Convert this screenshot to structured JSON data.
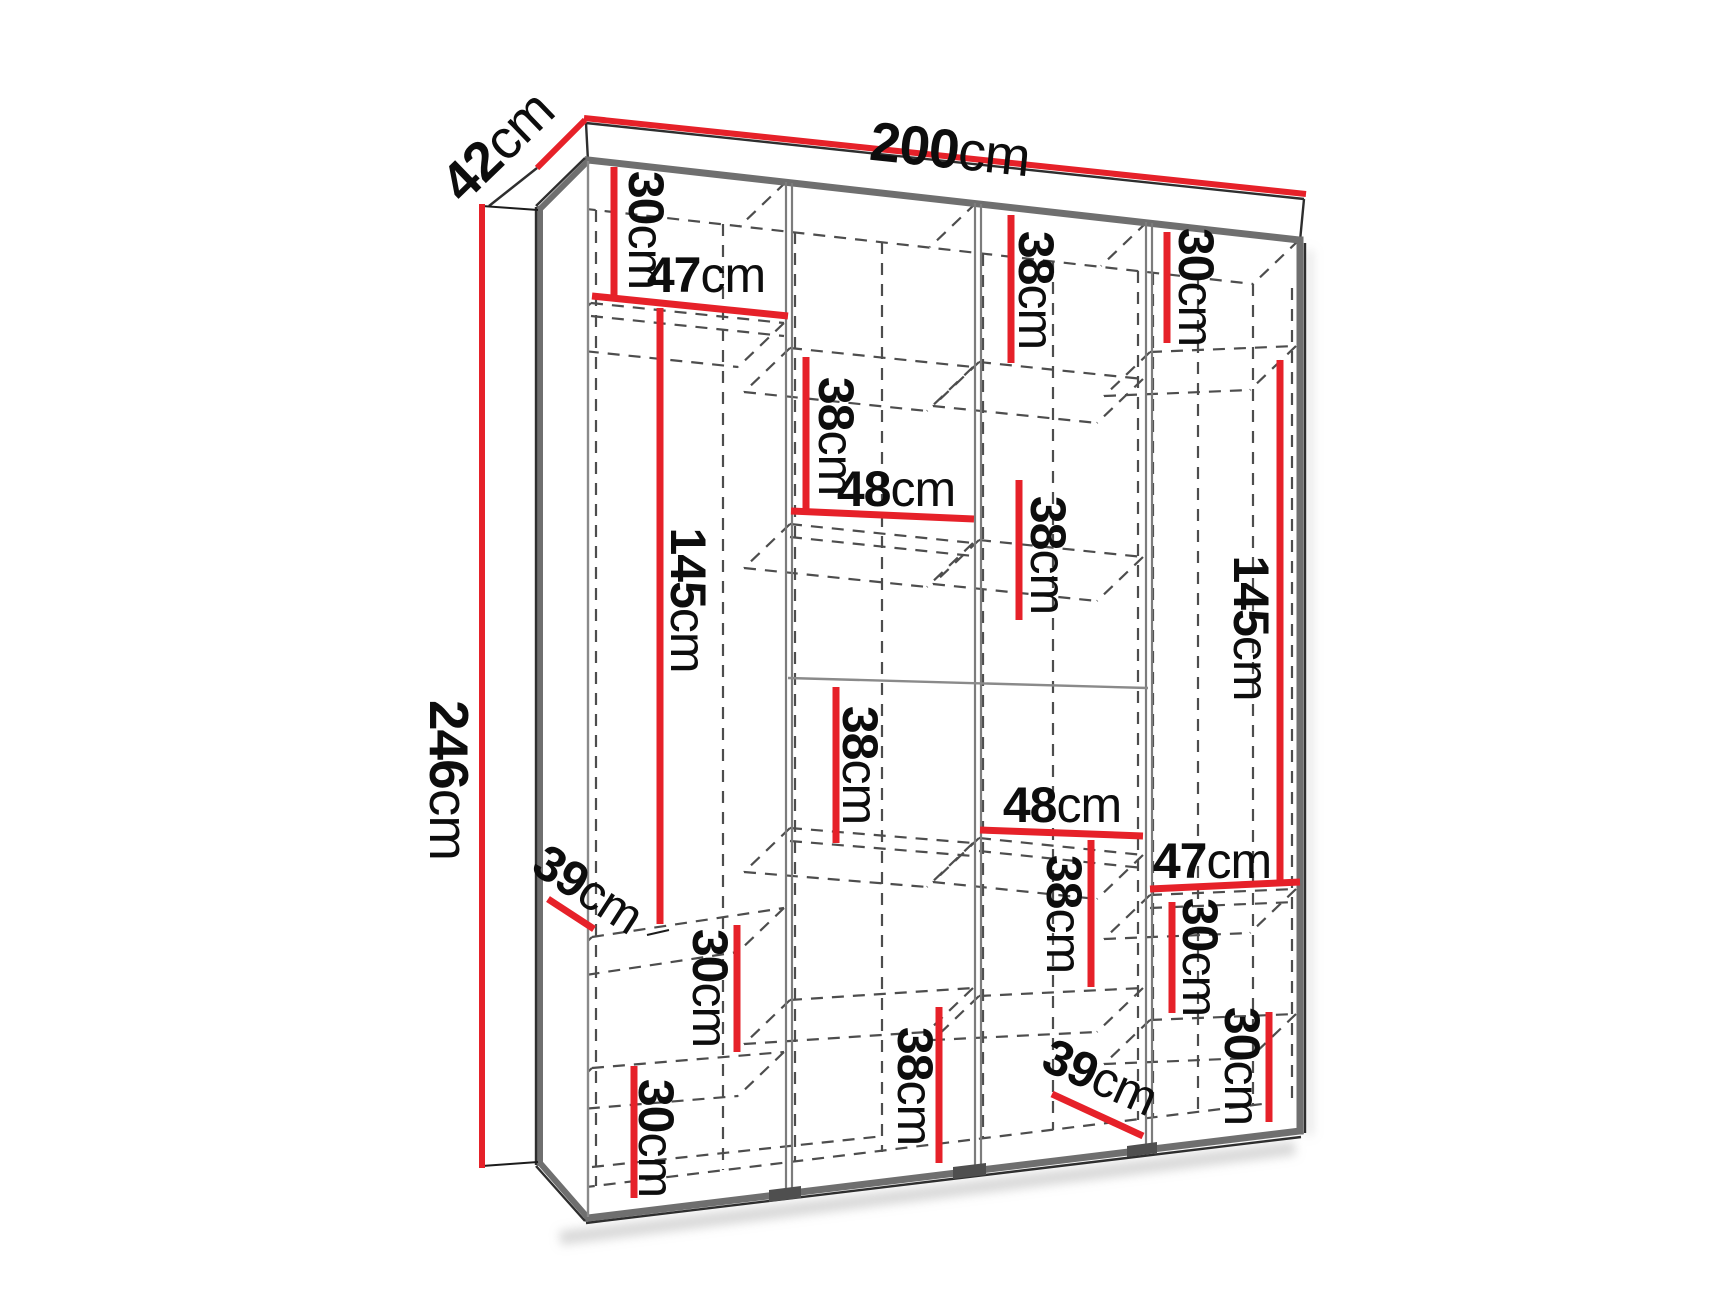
{
  "diagram": {
    "kind": "furniture dimension drawing",
    "subject": "wardrobe interior with 4 sections, shelves shown dashed",
    "unit": "cm"
  },
  "colors": {
    "dimension_line": "#e62129",
    "frame_gray": "#6f6f6f",
    "hidden_edge_gray": "#4d4d4d",
    "label_text": "#0d0d0d",
    "background": "#ffffff"
  },
  "overall": {
    "width": {
      "num": "200",
      "unit": "cm",
      "text": "200cm"
    },
    "depth": {
      "num": "42",
      "unit": "cm",
      "text": "42cm"
    },
    "height": {
      "num": "246",
      "unit": "cm",
      "text": "246cm"
    }
  },
  "labels": {
    "s1_top_30": {
      "num": "30",
      "unit": "cm",
      "text": "30cm"
    },
    "s1_shelf_47": {
      "num": "47",
      "unit": "cm",
      "text": "47cm"
    },
    "s1_hang_145": {
      "num": "145",
      "unit": "cm",
      "text": "145cm"
    },
    "left_depth_39response": {
      "num": "39",
      "unit": "cm",
      "text": "39cm"
    },
    "s1_low_30a": {
      "num": "30",
      "unit": "cm",
      "text": "30cm"
    },
    "s1_low_30b": {
      "num": "30",
      "unit": "cm",
      "text": "30cm"
    },
    "s2_top_38": {
      "num": "38",
      "unit": "cm",
      "text": "38cm"
    },
    "s2_shelf_48": {
      "num": "48",
      "unit": "cm",
      "text": "48cm"
    },
    "s2_mid_38": {
      "num": "38",
      "unit": "cm",
      "text": "38cm"
    },
    "s2_low_38": {
      "num": "38",
      "unit": "cm",
      "text": "38cm"
    },
    "s3_top_38": {
      "num": "38",
      "unit": "cm",
      "text": "38cm"
    },
    "s3_mid_38": {
      "num": "38",
      "unit": "cm",
      "text": "38cm"
    },
    "s3_shelf_48": {
      "num": "48",
      "unit": "cm",
      "text": "48cm"
    },
    "s3_low_38": {
      "num": "38",
      "unit": "cm",
      "text": "38cm"
    },
    "s3_depth_39": {
      "num": "39",
      "unit": "cm",
      "text": "39cm"
    },
    "s4_top_30": {
      "num": "30",
      "unit": "cm",
      "text": "30cm"
    },
    "s4_hang_145": {
      "num": "145",
      "unit": "cm",
      "text": "145cm"
    },
    "s4_shelf_47": {
      "num": "47",
      "unit": "cm",
      "text": "47cm"
    },
    "s4_mid_30": {
      "num": "30",
      "unit": "cm",
      "text": "30cm"
    },
    "s4_low_30": {
      "num": "30",
      "unit": "cm",
      "text": "30cm"
    }
  }
}
